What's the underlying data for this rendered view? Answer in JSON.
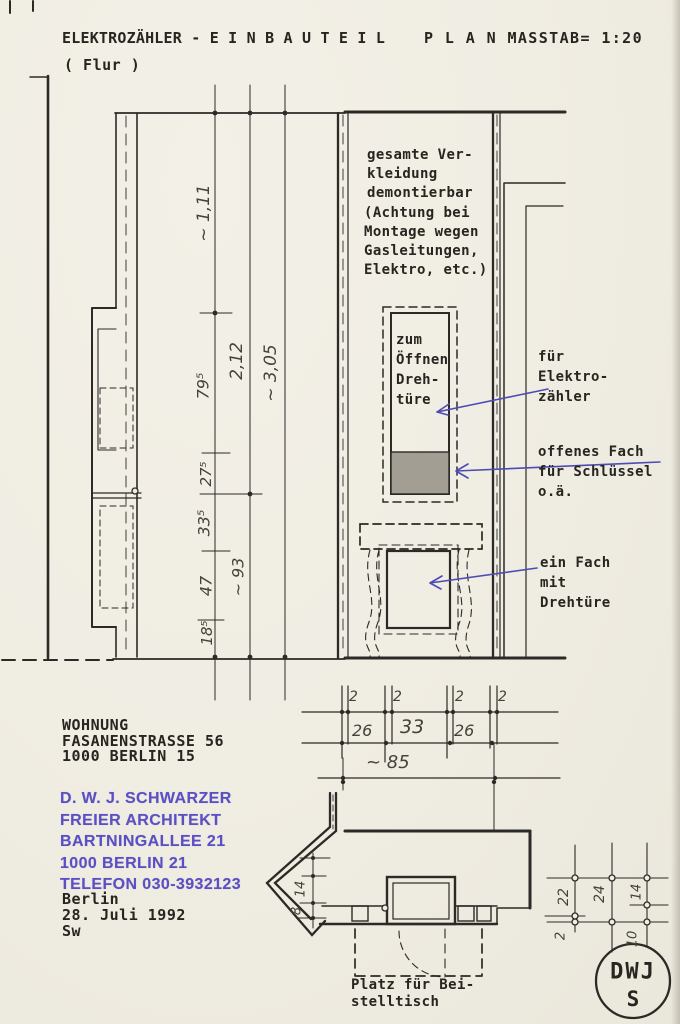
{
  "colors": {
    "paper": "#f0ede3",
    "ink": "#2b2a26",
    "pencil": "#45423c",
    "blue": "#4c4cb4",
    "stamp_purple": "#5b50c3",
    "shade_gray": "#a29e94"
  },
  "title": {
    "left": "ELEKTROZÄHLER -  E I N B A U T E I L",
    "right": "P L A N  MASSTAB= 1:20",
    "subtitle": "( Flur )"
  },
  "notes": {
    "cladding": "gesamte Ver-\nkleidung\ndemontierbar",
    "caution": "(Achtung bei\nMontage wegen\nGasleitungen,\nElektro, etc.)",
    "door_open": "zum\nÖffnen\nDreh-\ntüre",
    "meter": "für\nElektro-\nzähler",
    "open_shelf": "offenes Fach\nfür Schlüssel\no.ä.",
    "compartment": "ein Fach\nmit\nDrehtüre",
    "side_table": "Platz für Bei-\nstelltisch"
  },
  "dimensions": {
    "v111": "~ 1,11",
    "v212": "2,12",
    "v305": "~ 3,05",
    "v795": "79⁵",
    "v275": "27⁵",
    "v335": "33⁵",
    "v47": "47",
    "v185": "18⁵",
    "v93": "~ 93",
    "h2a": "2",
    "h2b": "2",
    "h2c": "2",
    "h2d": "2",
    "h26a": "26",
    "h33": "33",
    "h26b": "26",
    "h85": "~ 85",
    "plan14": "14",
    "plan8": "8",
    "g22": "22",
    "g24": "24",
    "g14": "14",
    "g2": "2",
    "g10": "10"
  },
  "address": {
    "block": "WOHNUNG\nFASANENSTRASSE 56\n1000  BERLIN  15"
  },
  "stamp": {
    "block": "D. W. J. SCHWARZER\nFREIER ARCHITEKT\nBARTNINGALLEE 21\n1000 BERLIN 21\nTELEFON 030-3932123"
  },
  "date": {
    "block": "Berlin\n28. Juli 1992\nSw"
  },
  "logo": {
    "top": "DWJ",
    "bottom": "S"
  }
}
